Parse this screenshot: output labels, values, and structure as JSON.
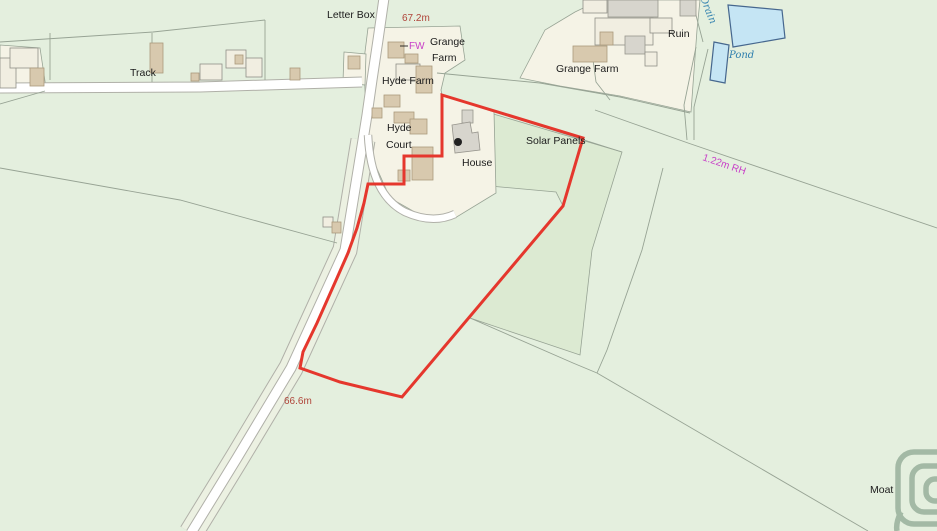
{
  "map": {
    "labels": {
      "letter_box": "Letter Box",
      "spot_height_north": "67.2m",
      "fw": "FW",
      "grange_farm_small_line1": "Grange",
      "grange_farm_small_line2": "Farm",
      "hyde_farm": "Hyde Farm",
      "grange_farm": "Grange Farm",
      "ruin": "Ruin",
      "pond": "Pond",
      "drain": "Drain",
      "track": "Track",
      "hyde_court_line1": "Hyde",
      "hyde_court_line2": "Court",
      "house": "House",
      "solar_panels": "Solar Panels",
      "fence_height": "1.22m RH",
      "spot_height_south": "66.6m",
      "moat": "Moat"
    },
    "colors": {
      "background": "#e4efde",
      "field_dark": "#dcead2",
      "plot_cream": "#f5f3e6",
      "road_fill": "#ffffff",
      "road_casing": "#b0b0a8",
      "verge": "#ecf1e2",
      "boundary_red": "#e5372d",
      "water_fill": "#c5e5f4",
      "water_outline": "#46678e",
      "building_tan": "#d8c9ae",
      "building_gray": "#d7d5cd",
      "building_cream": "#f1eee1",
      "moat_ring": "#a3b9a5",
      "field_line": "#97a394",
      "text_black": "#1c1c1c",
      "text_height": "#b0453a",
      "text_magenta": "#c83fc8",
      "text_water": "#2e7fae"
    }
  }
}
